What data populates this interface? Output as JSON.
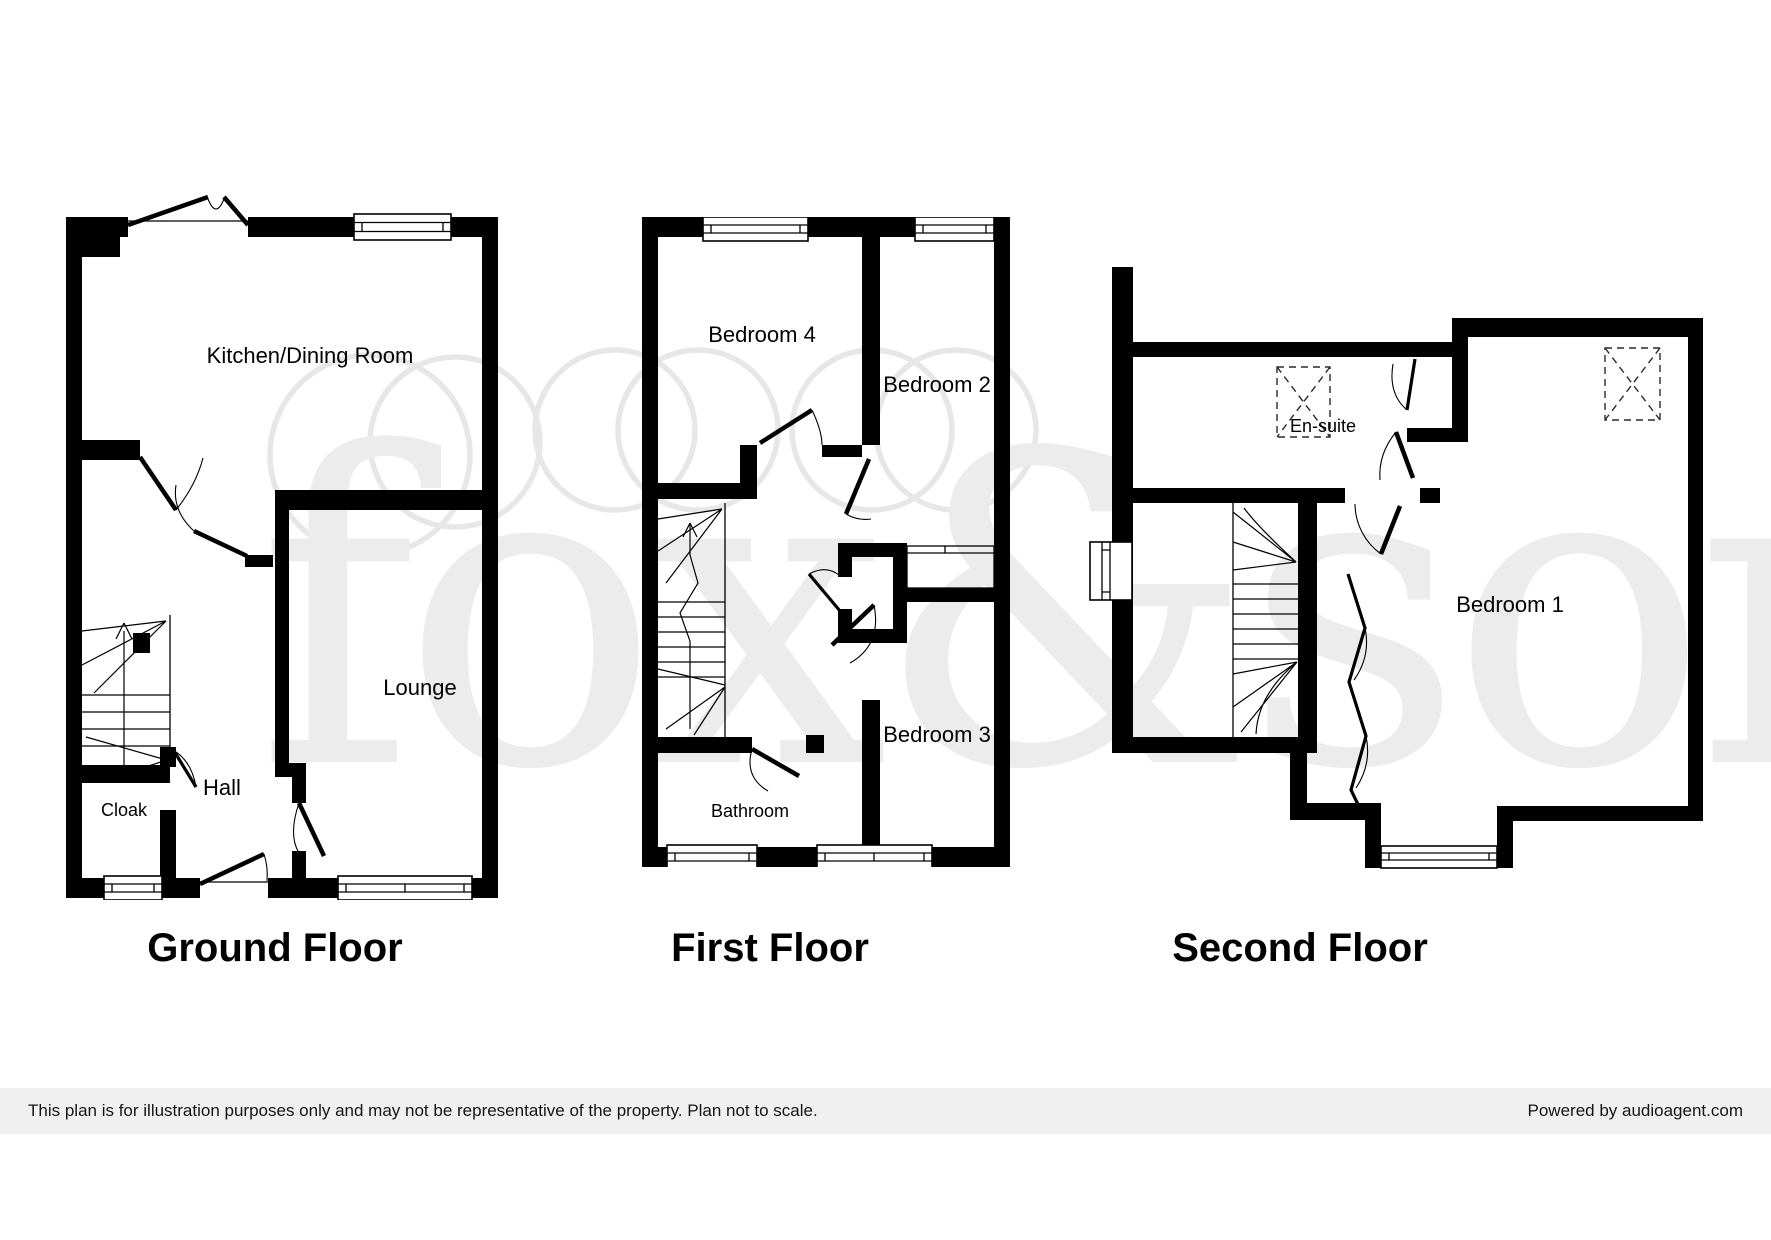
{
  "watermark": {
    "text": "fox&sons"
  },
  "floors": [
    {
      "title": "Ground Floor",
      "rooms": [
        {
          "label": "Kitchen/Dining Room"
        },
        {
          "label": "Lounge"
        },
        {
          "label": "Hall"
        },
        {
          "label": "Cloak"
        }
      ]
    },
    {
      "title": "First Floor",
      "rooms": [
        {
          "label": "Bedroom 4"
        },
        {
          "label": "Bedroom 2"
        },
        {
          "label": "Bedroom 3"
        },
        {
          "label": "Bathroom"
        }
      ]
    },
    {
      "title": "Second Floor",
      "rooms": [
        {
          "label": "En-suite"
        },
        {
          "label": "Bedroom 1"
        }
      ]
    }
  ],
  "footer": {
    "disclaimer": "This plan is for illustration purposes only and may not be representative of the property. Plan not to scale.",
    "credit": "Powered by audioagent.com"
  },
  "colors": {
    "wall": "#000000",
    "watermark": "#ececec",
    "footer_bg": "#f0f0f0"
  }
}
